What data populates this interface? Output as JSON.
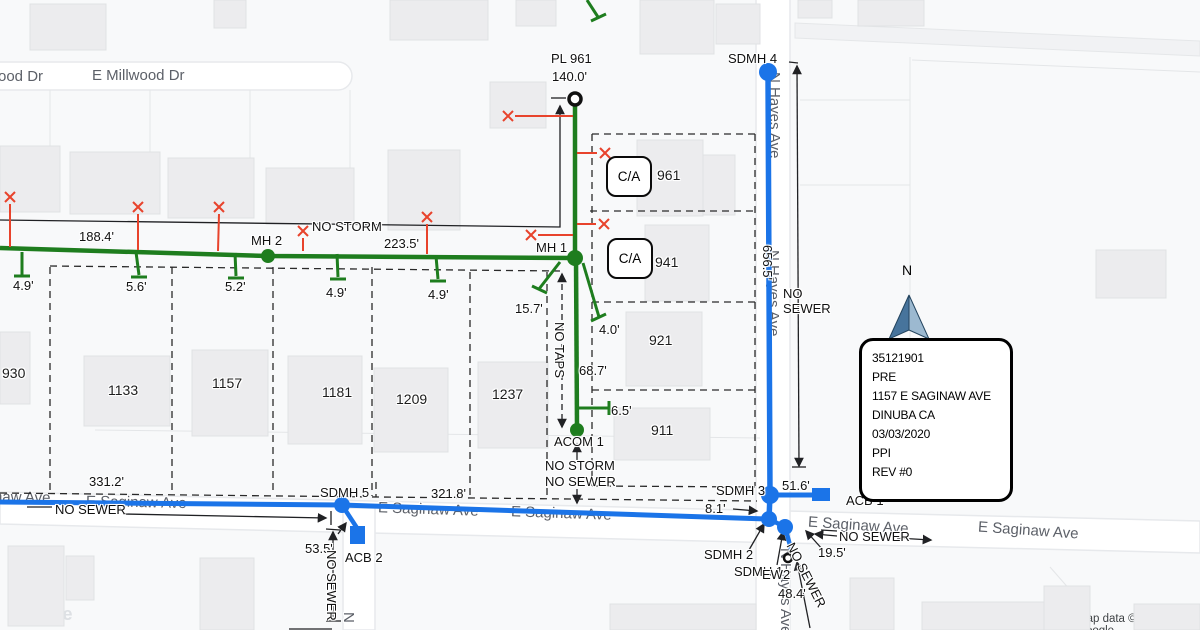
{
  "streets": {
    "millwood_cut": "ood Dr",
    "millwood": "E Millwood Dr",
    "saginaw": "E Saginaw Ave",
    "saginaw_cut": "naw Ave",
    "hayes": "N Hayes Ave",
    "cross_street_cut": "N"
  },
  "houses": {
    "h930": "930",
    "h1133": "1133",
    "h1157": "1157",
    "h1181": "1181",
    "h1209": "1209",
    "h1237": "1237",
    "h921": "921",
    "h911": "911",
    "h961": "961",
    "h941": "941"
  },
  "common_area": {
    "label": "C/A"
  },
  "structures": {
    "pl": "PL 961",
    "mh1": "MH 1",
    "mh2": "MH 2",
    "acom1": "ACOM 1",
    "sdmh1": "SDMH 1",
    "sdmh2": "SDMH 2",
    "sdmh3": "SDMH 3",
    "sdmh4": "SDMH 4",
    "sdmh5": "SDMH 5",
    "acb1": "ACB 1",
    "acb2": "ACB 2",
    "ew2": "EW2"
  },
  "measurements": {
    "m188_4": "188.4'",
    "m223_5": "223.5'",
    "m140_0": "140.0'",
    "m4_9a": "4.9'",
    "m5_6": "5.6'",
    "m5_2": "5.2'",
    "m4_9b": "4.9'",
    "m4_9c": "4.9'",
    "m15_7": "15.7'",
    "m4_0": "4.0'",
    "m68_7": "68.7'",
    "m6_5": "6.5'",
    "m656_5": "656.5'",
    "m331_2": "331.2'",
    "m321_8": "321.8'",
    "m53_5": "53.5'",
    "m8_1": "8.1'",
    "m51_6": "51.6'",
    "m19_5": "19.5'",
    "m48_4": "48.4'"
  },
  "notes": {
    "no_storm": "NO STORM",
    "no_sewer": "NO SEWER",
    "no_taps": "NO TAPS",
    "no_sewer_2line": "NO\nSEWER"
  },
  "info_box": {
    "lines": [
      "35121901",
      "PRE",
      "1157 E SAGINAW AVE",
      "DINUBA CA",
      "03/03/2020",
      "PPI",
      "REV #0"
    ]
  },
  "compass": {
    "north": "N"
  },
  "credits": {
    "google_logo": "Google",
    "attribution": "Map data ©2022 Google"
  },
  "colors": {
    "sewer_green": "#1e7d1e",
    "storm_blue": "#1b74e8",
    "mark_red": "#e8432c"
  }
}
